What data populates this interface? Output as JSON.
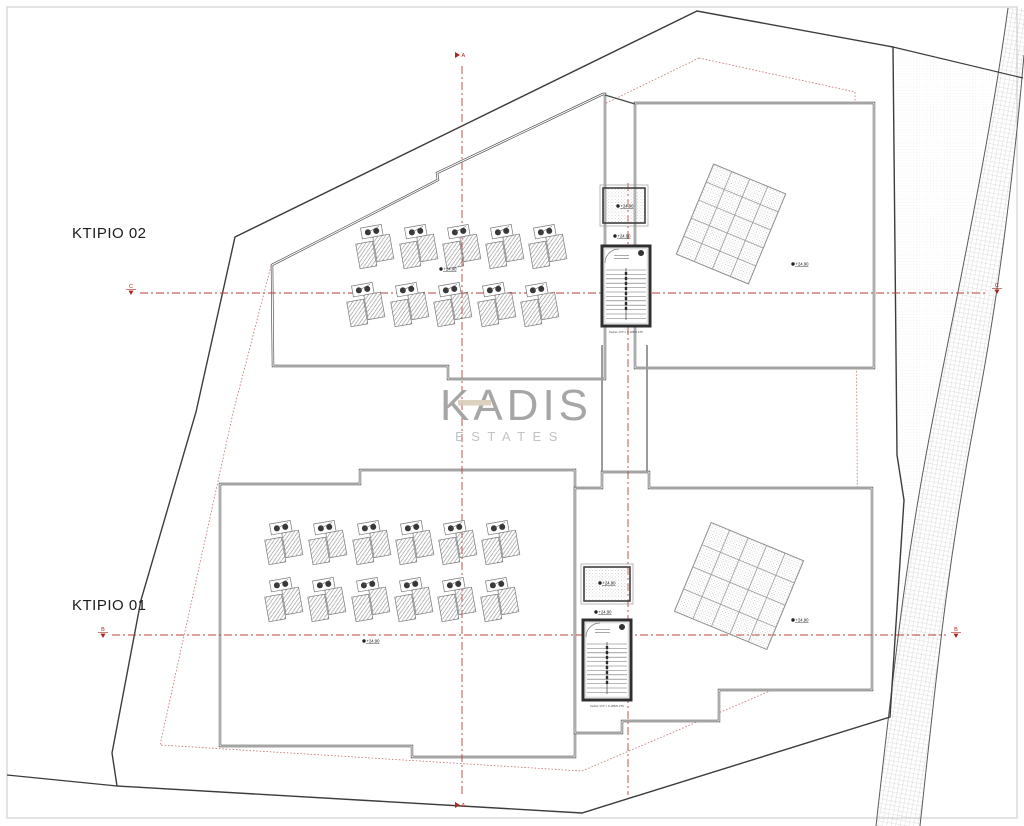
{
  "page": {
    "background": "#ffffff",
    "frame_color": "#c9c9c9"
  },
  "watermark": {
    "brand": "KADIS",
    "sub": "ESTATES",
    "brand_color": "#9d9d9d",
    "sub_color": "#bcbcbc",
    "accent_color": "#d8cdb8"
  },
  "axis_markers": {
    "top": "A",
    "bottom": "A",
    "mid_left": "C",
    "mid_right": "C",
    "low_left": "B",
    "low_right": "B"
  },
  "colors": {
    "boundary": "#3c3c3c",
    "wall": "#4a4a4a",
    "axis_red": "#bb4238",
    "setback_red": "#c4736b",
    "marker_red": "#a8281e",
    "label_dark": "#1c1c1c"
  },
  "buildings": [
    {
      "id": "ktirio-02",
      "label": "KTIPIO 02",
      "label_pos": {
        "x": 72,
        "y": 238
      },
      "panel_rows": [
        {
          "y": 247,
          "xs": [
            374,
            418,
            461,
            504,
            547
          ]
        },
        {
          "y": 305,
          "xs": [
            365,
            409,
            452,
            496,
            539
          ]
        }
      ],
      "pergola": {
        "cx": 731,
        "cy": 224,
        "cols": 4,
        "rows": 5,
        "cell_w": 19.5,
        "cell_h": 19.5,
        "angle": 22.5
      },
      "skylight": {
        "x": 603,
        "y": 188,
        "w": 42,
        "h": 35
      },
      "stair": {
        "x": 602,
        "y": 246,
        "w": 48,
        "h": 80,
        "note_y": 333
      },
      "stair_note": "Σκάλα 17Ρ × 0.185/0.275"
    },
    {
      "id": "ktirio-01",
      "label": "KTIPIO 01",
      "label_pos": {
        "x": 72,
        "y": 610
      },
      "panel_rows": [
        {
          "y": 543,
          "xs": [
            283,
            327,
            371,
            414,
            457,
            500
          ]
        },
        {
          "y": 600,
          "xs": [
            283,
            326,
            370,
            413,
            456,
            499
          ]
        }
      ],
      "pergola": {
        "cx": 739,
        "cy": 586,
        "cols": 5,
        "rows": 4,
        "cell_w": 20,
        "cell_h": 24,
        "angle": 22.5
      },
      "skylight": {
        "x": 584,
        "y": 567,
        "w": 46,
        "h": 34
      },
      "stair": {
        "x": 583,
        "y": 620,
        "w": 48,
        "h": 80,
        "note_y": 707
      },
      "stair_note": "Σκάλα 17Ρ × 0.185/0.275"
    }
  ],
  "elevation_marks": [
    {
      "x": 618,
      "y": 206,
      "value": "+24.90"
    },
    {
      "x": 615,
      "y": 236,
      "value": "+24.90"
    },
    {
      "x": 441,
      "y": 269,
      "value": "+24.90"
    },
    {
      "x": 793,
      "y": 264,
      "value": "+24.90"
    },
    {
      "x": 600,
      "y": 583,
      "value": "+24.90"
    },
    {
      "x": 596,
      "y": 612,
      "value": "+24.90"
    },
    {
      "x": 364,
      "y": 641,
      "value": "+24.90"
    },
    {
      "x": 793,
      "y": 620,
      "value": "+24.90"
    }
  ]
}
